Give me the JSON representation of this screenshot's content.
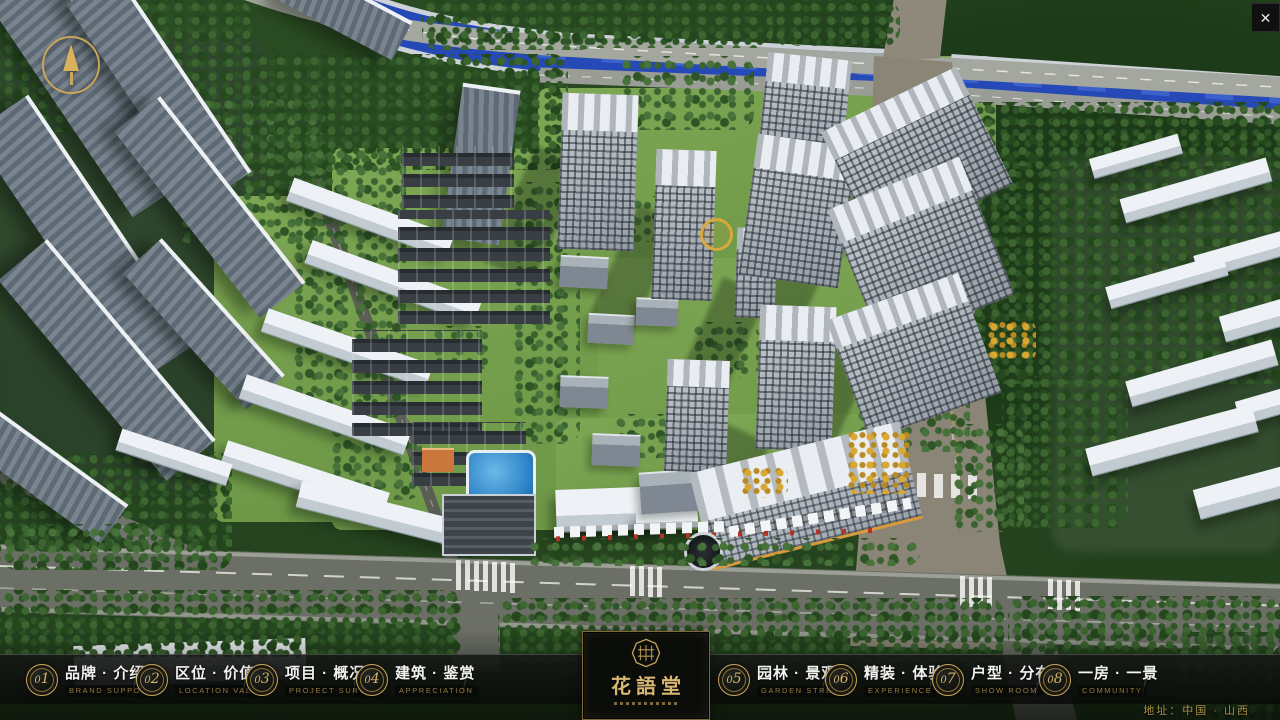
{
  "window": {
    "close_glyph": "✕"
  },
  "logo": {
    "name": "花語堂"
  },
  "nav": {
    "items": [
      {
        "num": "01",
        "label": "品牌 · 介绍",
        "sub": "BRAND SUPPORT"
      },
      {
        "num": "02",
        "label": "区位 · 价值",
        "sub": "LOCATION VALUE"
      },
      {
        "num": "03",
        "label": "项目 · 概况",
        "sub": "PROJECT SURVEY"
      },
      {
        "num": "04",
        "label": "建筑 · 鉴赏",
        "sub": "APPRECIATION"
      },
      {
        "num": "05",
        "label": "园林 · 景观",
        "sub": "GARDEN STREET"
      },
      {
        "num": "06",
        "label": "精装 · 体验",
        "sub": "EXPERIENCE"
      },
      {
        "num": "07",
        "label": "户型 · 分布",
        "sub": "SHOW ROOM"
      },
      {
        "num": "08",
        "label": "一房 · 一景",
        "sub": "COMMUNITY"
      }
    ]
  },
  "footer": {
    "address": "地址：中国 · 山西"
  },
  "colors": {
    "gold": "#c9a45e",
    "nav_text": "#f2f2f0",
    "nav_sub": "#96793f",
    "river": "#2549b6",
    "bar_bg": "rgba(8,10,8,0.84)"
  }
}
